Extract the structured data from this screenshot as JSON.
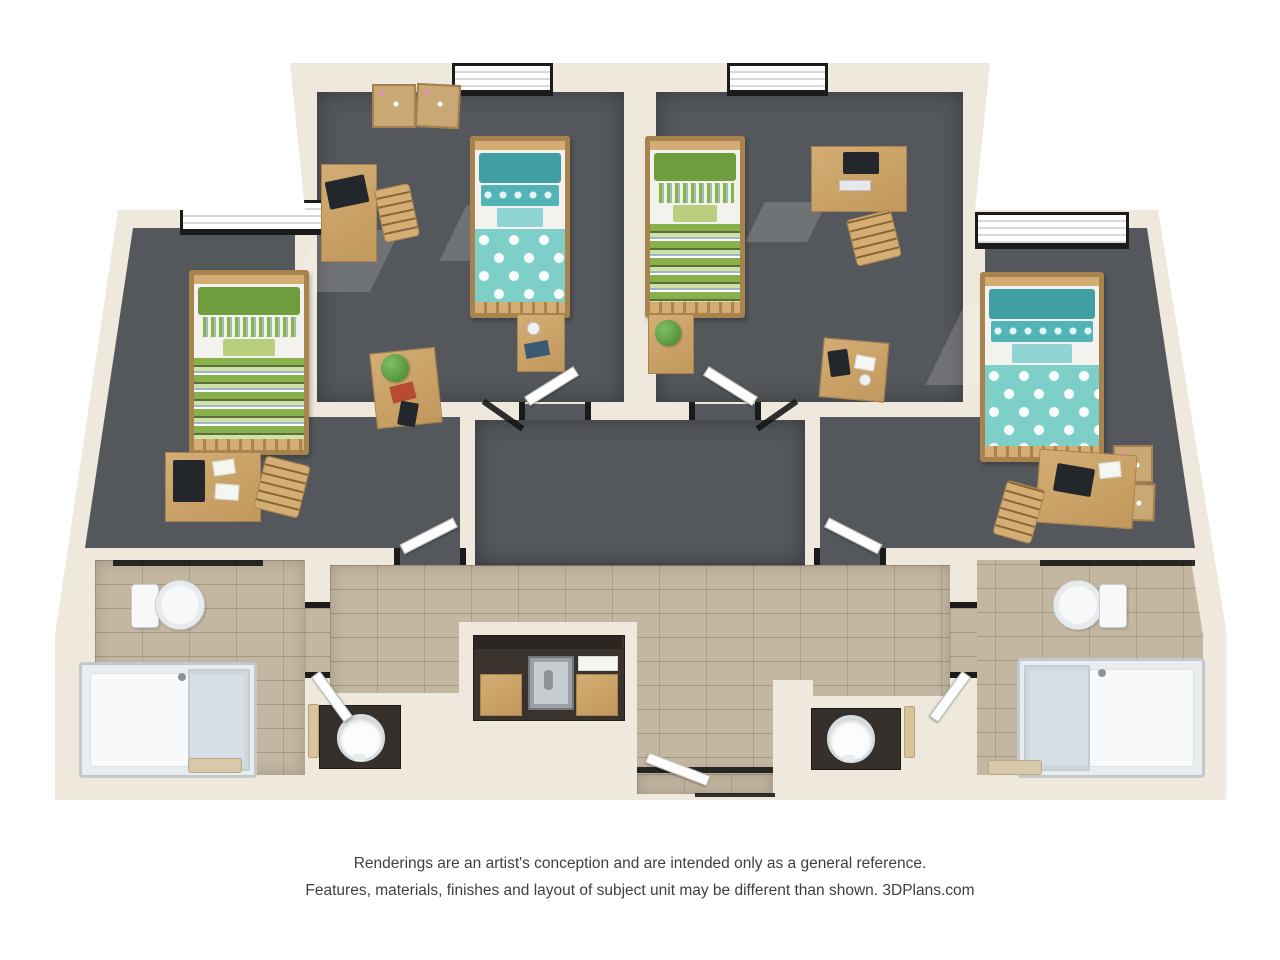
{
  "disclaimer": {
    "line1": "Renderings are an artist's conception and are intended only as a general reference.",
    "line2": "Features, materials, finishes and layout of subject unit may be different than shown. 3DPlans.com"
  },
  "palette": {
    "wall": "#eee9dc",
    "wall-shade": "#dcd6c6",
    "carpet": "#54575b",
    "carpet-dark": "#45484c",
    "tile": "#c4b7a1",
    "grout": "#ab9d85",
    "wood": "#d3ad74",
    "wood-dark": "#a8834e",
    "teal": "#7fcfc9",
    "teal-mid": "#52b4b6",
    "teal-dark": "#3f9fa3",
    "teal-light": "#8fd4d2",
    "green": "#86b14b",
    "green-dark": "#6f9c3d",
    "green-light": "#cfe0a8",
    "blue-stripe": "#9fb8c8",
    "frame": "#1b1b1b",
    "door": "#fdfdfd",
    "fixture": "#f6f8f9",
    "glass": "#c8d4db",
    "counter": "#35302b",
    "steel": "#b4b9bc",
    "plant": "#55943f",
    "cork": "#c9a876",
    "accent-red": "#b64a32",
    "text": "#3f3f3f"
  },
  "plan": {
    "type": "3d-floor-plan-rendering",
    "unit": "four-bedroom two-bathroom dormitory suite",
    "rooms": {
      "bedroom_left": {
        "bedding": "green-stripe",
        "furniture": [
          "window",
          "twin-bed",
          "desk",
          "laptop",
          "desk-chair",
          "coffee-table",
          "plant",
          "red-book",
          "tablet"
        ]
      },
      "bedroom_center_left": {
        "bedding": "teal-pattern",
        "furniture": [
          "bulletin-boards",
          "window",
          "desk",
          "laptop",
          "desk-chair",
          "twin-bed",
          "nightstand",
          "mug",
          "book"
        ]
      },
      "bedroom_center_right": {
        "bedding": "green-stripe",
        "furniture": [
          "window",
          "desk",
          "monitor",
          "desk-chair",
          "twin-bed",
          "nightstand",
          "plant",
          "side-table",
          "tablet"
        ]
      },
      "bedroom_right": {
        "bedding": "teal-pattern",
        "furniture": [
          "window",
          "twin-bed",
          "desk",
          "laptop",
          "desk-chair",
          "cork-boards"
        ]
      },
      "entry_hall": {
        "floor": "carpet",
        "doors": [
          "bedroom-center-left",
          "bedroom-center-right",
          "bedroom-left",
          "bedroom-right"
        ]
      },
      "corridor": {
        "floor": "tile",
        "fixtures": [
          "kitchenette-sink",
          "wood-cabinets",
          "entry-door"
        ]
      },
      "bathroom_left": {
        "floor": "tile",
        "fixtures": [
          "toilet",
          "shower",
          "vanity-sink",
          "towel-bar",
          "bath-mat"
        ]
      },
      "bathroom_right": {
        "floor": "tile",
        "fixtures": [
          "toilet",
          "shower",
          "vanity-sink",
          "towel-bar",
          "bath-mat"
        ]
      }
    }
  }
}
